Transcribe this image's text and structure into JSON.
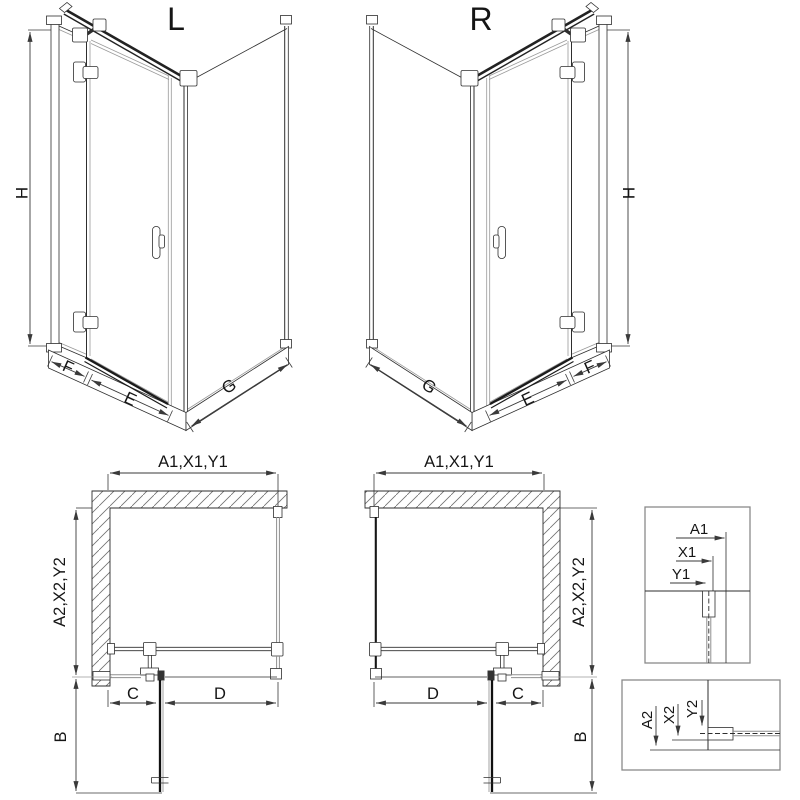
{
  "drawing": {
    "iso_left": {
      "title": "L",
      "dim_height": "H",
      "dim_fixed": "F",
      "dim_door": "E",
      "dim_side": "G"
    },
    "iso_right": {
      "title": "R",
      "dim_height": "H",
      "dim_fixed": "F",
      "dim_door": "E",
      "dim_side": "G"
    },
    "plan_left": {
      "dim_top": "A1,X1,Y1",
      "dim_side": "A2,X2,Y2",
      "dim_door_open": "B",
      "dim_c": "C",
      "dim_d": "D"
    },
    "plan_right": {
      "dim_top": "A1,X1,Y1",
      "dim_side": "A2,X2,Y2",
      "dim_door_open": "B",
      "dim_c": "C",
      "dim_d": "D"
    },
    "detail_top": {
      "dim_a": "A1",
      "dim_x": "X1",
      "dim_y": "Y1"
    },
    "detail_bottom": {
      "dim_a": "A2",
      "dim_x": "X2",
      "dim_y": "Y2"
    },
    "colors": {
      "line": "#2e2e2e",
      "glass": "#8f8f8f",
      "dim": "#3a3a3a",
      "hatch": "#707070",
      "detail_box": "#8a8a8a",
      "background": "#ffffff"
    }
  }
}
